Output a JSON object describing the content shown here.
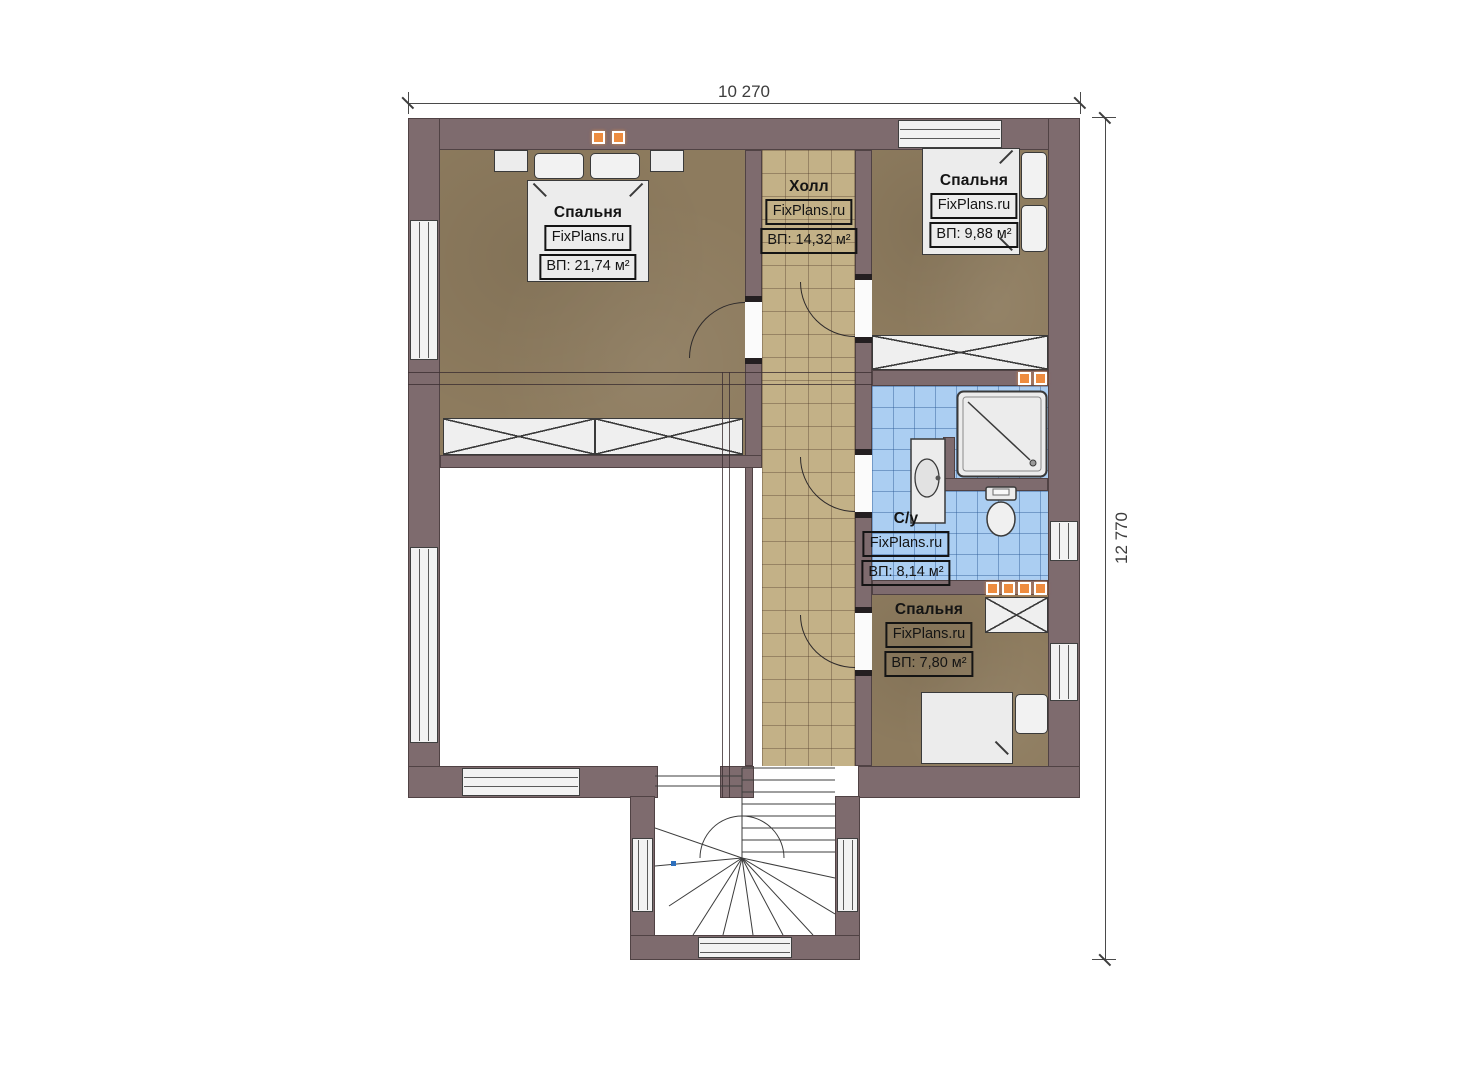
{
  "dimensions": {
    "width_label": "10 270",
    "height_label": "12 770"
  },
  "rooms": [
    {
      "name": "Спальня",
      "brand": "FixPlans.ru",
      "area": "ВП: 21,74 м²"
    },
    {
      "name": "Холл",
      "brand": "FixPlans.ru",
      "area": "ВП: 14,32 м²"
    },
    {
      "name": "Спальня",
      "brand": "FixPlans.ru",
      "area": "ВП: 9,88 м²"
    },
    {
      "name": "С/у",
      "brand": "FixPlans.ru",
      "area": "ВП: 8,14 м²"
    },
    {
      "name": "Спальня",
      "brand": "FixPlans.ru",
      "area": "ВП: 7,80 м²"
    }
  ],
  "colors": {
    "wall": "#7e6b6e",
    "wood_floor": "#8d7b5e",
    "hall_tile": "#c3b187",
    "bath_tile": "#abcef2",
    "vent": "#ee8c3f",
    "line": "#3d3d3d"
  }
}
